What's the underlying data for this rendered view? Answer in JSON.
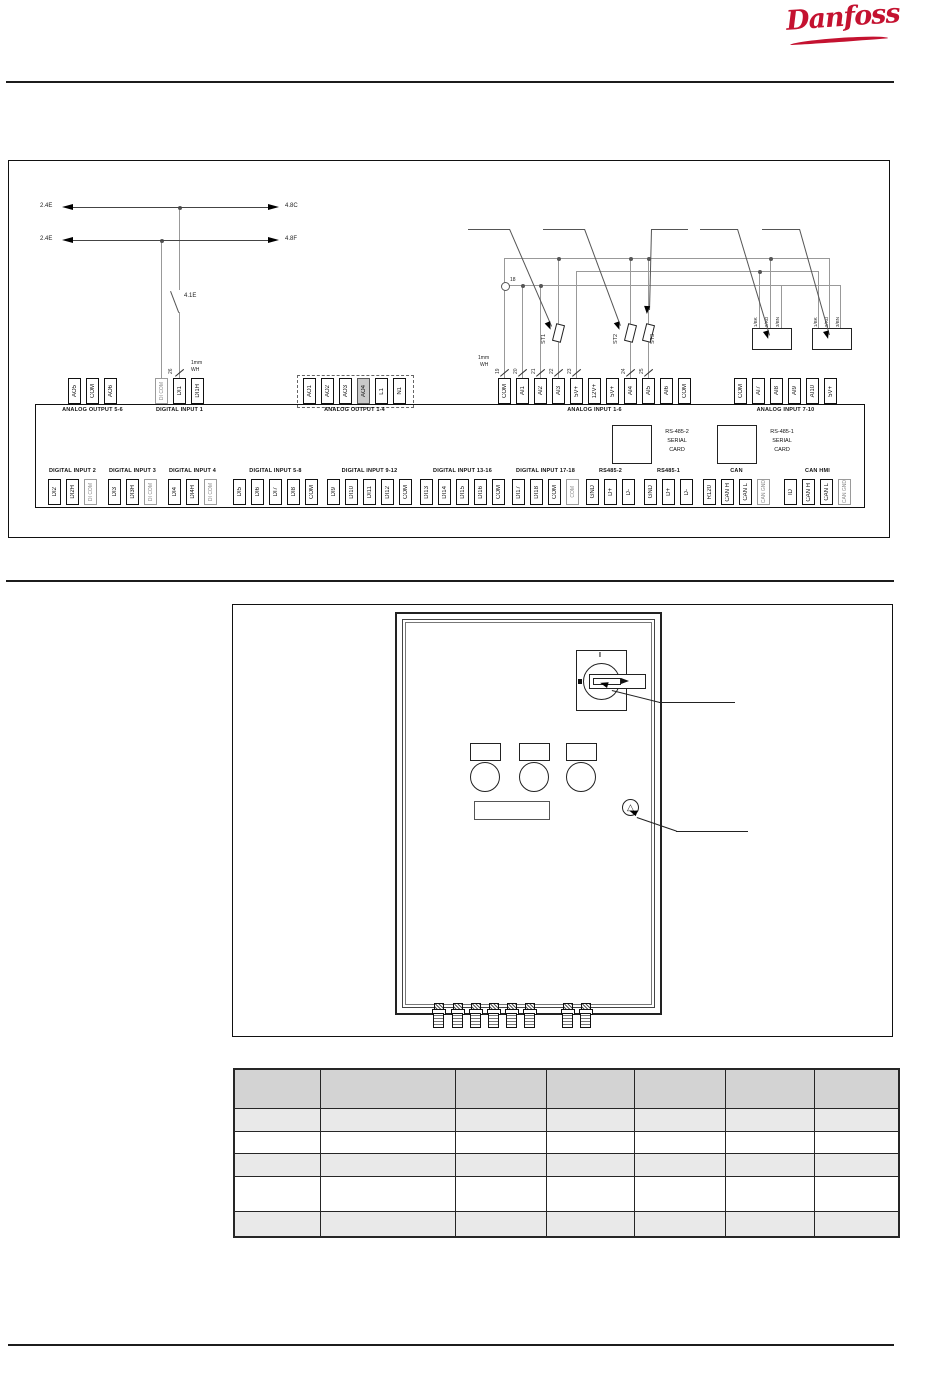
{
  "logo": {
    "text": "Danfoss",
    "color": "#c41230"
  },
  "wiring": {
    "arrow_rows": [
      {
        "left": "2.4E",
        "right": "4.8C"
      },
      {
        "left": "2.4E",
        "right": "4.8F"
      }
    ],
    "switch_label": "4.1E",
    "di1_wire_number": "26",
    "wire_gauge": {
      "line1": "1mm",
      "line2": "WH"
    },
    "node_label": "18",
    "wire_numbers": [
      "19",
      "20",
      "21",
      "22",
      "23",
      "24",
      "25"
    ],
    "sensors": [
      "ST1",
      "ST2",
      "ST3"
    ],
    "transmitter_wire_labels": [
      "1/BK",
      "2/RD",
      "3/BN"
    ],
    "serial_cards": [
      [
        "RS-485-2",
        "SERIAL",
        "CARD"
      ],
      [
        "RS-485-1",
        "SERIAL",
        "CARD"
      ]
    ],
    "top_groups": [
      {
        "label": "ANALOG OUTPUT 5-6",
        "x": 68,
        "terminals": [
          {
            "t": "AO5"
          },
          {
            "t": "COM"
          },
          {
            "t": "AO6"
          }
        ]
      },
      {
        "label": "DIGITAL INPUT 1",
        "x": 155,
        "terminals": [
          {
            "t": "DI COM",
            "gray": true
          },
          {
            "t": "DI1"
          },
          {
            "t": "DI1H"
          }
        ]
      },
      {
        "label": "ANALOG OUTPUT 1-4",
        "x": 303,
        "dashed": true,
        "terminals": [
          {
            "t": "AO1"
          },
          {
            "t": "AO2"
          },
          {
            "t": "AO3"
          },
          {
            "t": "AO4",
            "fill": true
          },
          {
            "t": "L1"
          },
          {
            "t": "N1"
          }
        ]
      },
      {
        "label": "ANALOG INPUT 1-6",
        "x": 498,
        "terminals": [
          {
            "t": "COM"
          },
          {
            "t": "AI1"
          },
          {
            "t": "AI2"
          },
          {
            "t": "AI3"
          },
          {
            "t": "5V+"
          },
          {
            "t": "12V+"
          },
          {
            "t": "5V+"
          },
          {
            "t": "AI4"
          },
          {
            "t": "AI5"
          },
          {
            "t": "AI6"
          },
          {
            "t": "COM"
          }
        ]
      },
      {
        "label": "ANALOG INPUT 7-10",
        "x": 734,
        "terminals": [
          {
            "t": "COM"
          },
          {
            "t": "AI7"
          },
          {
            "t": "AI8"
          },
          {
            "t": "AI9"
          },
          {
            "t": "AI10"
          },
          {
            "t": "5V+"
          }
        ]
      }
    ],
    "bottom_groups": [
      {
        "label": "DIGITAL INPUT 2",
        "x": 48,
        "terminals": [
          {
            "t": "DI2"
          },
          {
            "t": "DI2H"
          },
          {
            "t": "DI COM",
            "gray": true
          }
        ]
      },
      {
        "label": "DIGITAL INPUT 3",
        "x": 108,
        "terminals": [
          {
            "t": "DI3"
          },
          {
            "t": "DI3H"
          },
          {
            "t": "DI COM",
            "gray": true
          }
        ]
      },
      {
        "label": "DIGITAL INPUT 4",
        "x": 168,
        "terminals": [
          {
            "t": "DI4"
          },
          {
            "t": "DI4H"
          },
          {
            "t": "DI COM",
            "gray": true
          }
        ]
      },
      {
        "label": "DIGITAL INPUT 5-8",
        "x": 233,
        "terminals": [
          {
            "t": "DI5"
          },
          {
            "t": "DI6"
          },
          {
            "t": "DI7"
          },
          {
            "t": "DI8"
          },
          {
            "t": "COM"
          }
        ]
      },
      {
        "label": "DIGITAL INPUT 9-12",
        "x": 327,
        "terminals": [
          {
            "t": "DI9"
          },
          {
            "t": "DI10"
          },
          {
            "t": "DI11"
          },
          {
            "t": "DI12"
          },
          {
            "t": "COM"
          }
        ]
      },
      {
        "label": "DIGITAL INPUT 13-16",
        "x": 420,
        "terminals": [
          {
            "t": "DI13"
          },
          {
            "t": "DI14"
          },
          {
            "t": "DI15"
          },
          {
            "t": "DI16"
          },
          {
            "t": "COM"
          }
        ]
      },
      {
        "label": "DIGITAL INPUT 17-18",
        "x": 512,
        "terminals": [
          {
            "t": "DI17"
          },
          {
            "t": "DI18"
          },
          {
            "t": "COM"
          },
          {
            "t": "COM",
            "gray": true
          }
        ]
      },
      {
        "label": "RS485-2",
        "x": 586,
        "terminals": [
          {
            "t": "GND"
          },
          {
            "t": "D+"
          },
          {
            "t": "D-"
          }
        ]
      },
      {
        "label": "RS485-1",
        "x": 644,
        "terminals": [
          {
            "t": "GND"
          },
          {
            "t": "D+"
          },
          {
            "t": "D-"
          }
        ]
      },
      {
        "label": "CAN",
        "x": 703,
        "terminals": [
          {
            "t": "R120"
          },
          {
            "t": "CAN H"
          },
          {
            "t": "CAN L"
          },
          {
            "t": "CAN GND",
            "gray": true
          }
        ]
      },
      {
        "label": "CAN HMI",
        "x": 784,
        "terminals": [
          {
            "t": "ID"
          },
          {
            "t": "CAN H"
          },
          {
            "t": "CAN L"
          },
          {
            "t": "CAN GND",
            "gray": true
          }
        ]
      }
    ]
  },
  "cabinet": {
    "switch_on_label": "I"
  },
  "table": {
    "rows": [
      [
        "",
        "",
        "",
        "",
        "",
        "",
        ""
      ],
      [
        "",
        "",
        "",
        "",
        "",
        "",
        ""
      ],
      [
        "",
        "",
        "",
        "",
        "",
        "",
        ""
      ],
      [
        "",
        "",
        "",
        "",
        "",
        "",
        ""
      ],
      [
        "",
        "",
        "",
        "",
        "",
        "",
        ""
      ],
      [
        "",
        "",
        "",
        "",
        "",
        "",
        ""
      ]
    ]
  }
}
